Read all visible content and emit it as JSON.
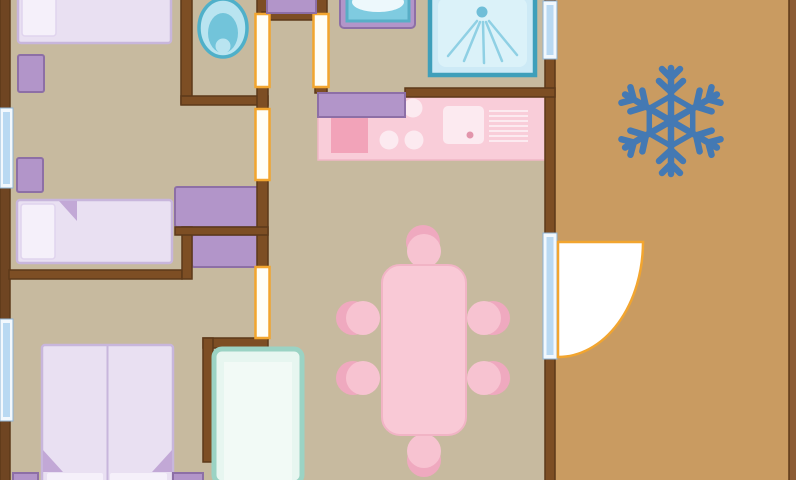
{
  "plan": {
    "type": "floor-plan",
    "title": "mobile-home-floor-plan-with-terrace",
    "rooms": [
      "twin-bedroom",
      "wc",
      "hallway",
      "bathroom",
      "master-bedroom",
      "kitchen",
      "dining-area",
      "living-area",
      "terrace"
    ],
    "furniture_counts": {
      "single_beds": 2,
      "double_beds": 1,
      "nightstands": 4,
      "wardrobes": 3,
      "hall_cabinets": 1,
      "kitchen_wall_cabinets": 1,
      "kitchen_counters": 1,
      "hob_burners": 3,
      "kitchen_sinks": 1,
      "dining_tables": 1,
      "dining_chairs": 6,
      "toilets": 1,
      "washbasins": 1,
      "showers": 1,
      "storage_cabinets_teal": 1
    },
    "doors": {
      "interior_sliding": 4,
      "entry_swing": 1
    },
    "windows": 3,
    "icons": [
      "snowflake-icon"
    ]
  },
  "colors": {
    "floor_interior": "#c7ba9f",
    "floor_terrace": "#c99b61",
    "wall": "#7d4e24",
    "wall_dark": "#5d3919",
    "wall_exterior": "#6f4522",
    "wall_terrace_edge": "#8c5c34",
    "window_frame": "#f2f8fd",
    "window_glass": "#b9d9f2",
    "window_edge": "#8fb3d4",
    "door_leaf": "#fffef7",
    "door_frame": "#f2a52f",
    "bed_fill": "#e9e0f2",
    "bed_border": "#c8b6dc",
    "pillow": "#f5f0fa",
    "pillow_edge": "#e0d4ee",
    "fold": "#c2a8d6",
    "furniture_purple": "#b295c9",
    "furniture_purple_border": "#8d6fa6",
    "counter_pink": "#f9cdd9",
    "counter_edge": "#f0b6c6",
    "counter_pink_dark": "#f2a3b9",
    "counter_pink_light": "#fceaf0",
    "sink_dot": "#e295ab",
    "table_pink": "#f9c9d6",
    "table_edge": "#f1b4c5",
    "chair_pink": "#f7c3d1",
    "chair_shadow": "#efa9bf",
    "fixture_teal_dark": "#3f9fba",
    "fixture_blue": "#7fcbe0",
    "fixture_blue_mid": "#58aec6",
    "fixture_blue_light": "#cdeaf6",
    "fixture_blue_pale": "#dbf2f9",
    "fixture_white": "#edf8fc",
    "spray": "#8fd0e4",
    "spray_dot": "#6fbed8",
    "toilet_ring": "#4fb0c9",
    "toilet_fill": "#b9e4f0",
    "toilet_inner": "#72c4da",
    "cabinet_teal_border": "#9bd3c4",
    "cabinet_teal_fill": "#e7f6f0",
    "cabinet_teal_inner": "#f2faf6",
    "snowflake": "#4479b3"
  }
}
